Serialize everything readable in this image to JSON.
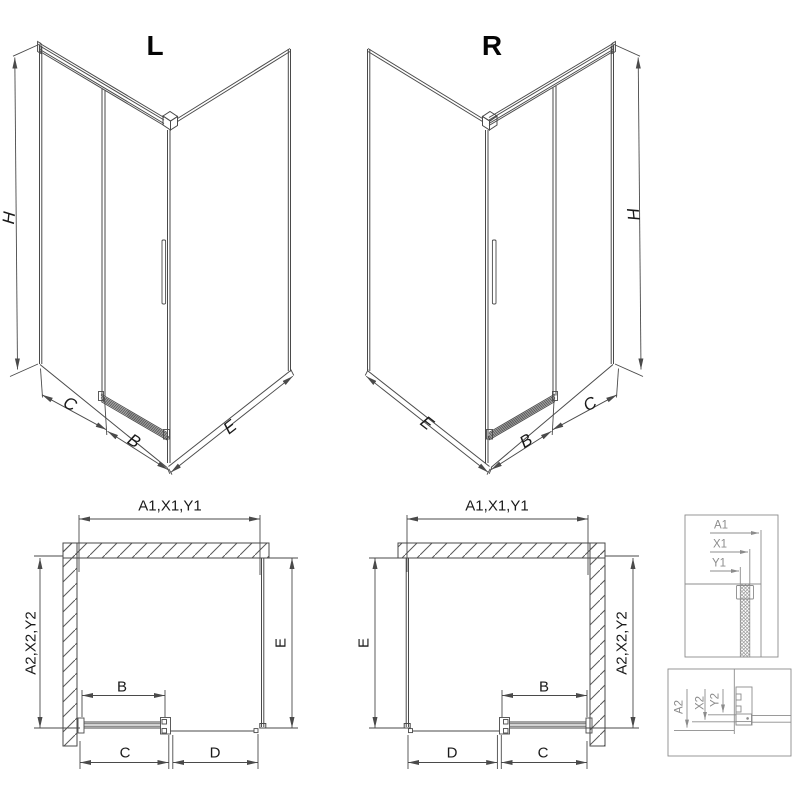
{
  "labels": {
    "title_left": "L",
    "title_right": "R",
    "dim_h": "H",
    "dim_b": "B",
    "dim_c": "C",
    "dim_d": "D",
    "dim_e": "E",
    "dim_width_refs": "A1,X1,Y1",
    "dim_depth_refs": "A2,X2,Y2",
    "ref_a1": "A1",
    "ref_x1": "X1",
    "ref_y1": "Y1",
    "ref_a2": "A2",
    "ref_x2": "X2",
    "ref_y2": "Y2"
  },
  "colors": {
    "line": "#4a4a4a",
    "text": "#1a1a1a",
    "detail": "#8c8c8c",
    "background": "#ffffff"
  }
}
